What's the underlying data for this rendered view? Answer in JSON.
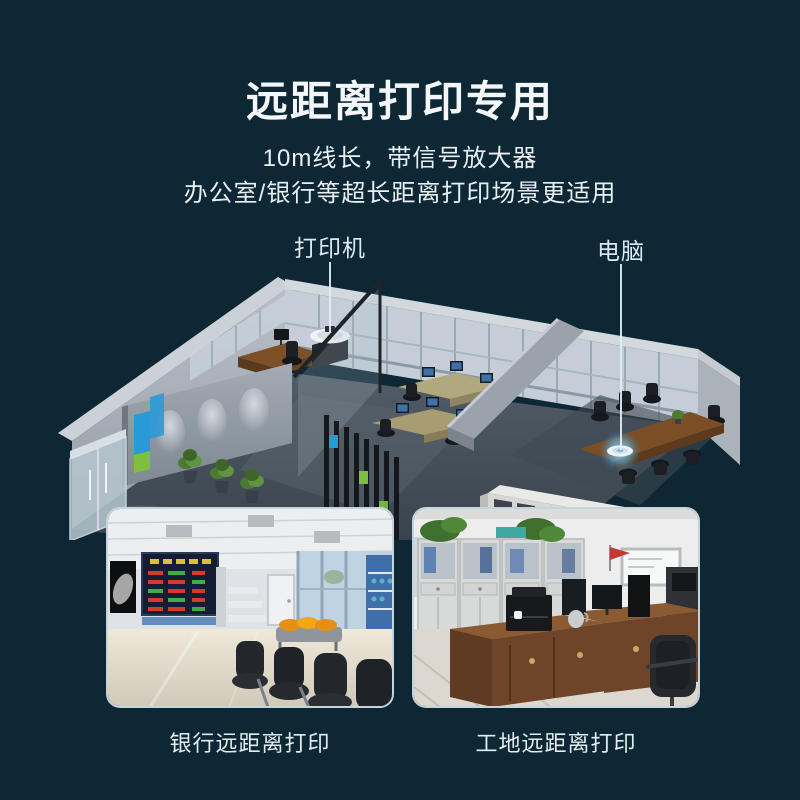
{
  "header": {
    "title": "远距离打印专用",
    "subtitle_line1": "10m线长，带信号放大器",
    "subtitle_line2": "办公室/银行等超长距离打印场景更适用"
  },
  "callouts": {
    "printer_label": "打印机",
    "computer_label": "电脑"
  },
  "photos": {
    "left_caption": "银行远距离打印",
    "right_caption": "工地远距离打印"
  },
  "colors": {
    "background": "#0d2734",
    "title_text": "#f4f7f9",
    "callout_line": "#dfeff8",
    "accent_blue": "#2a9ad6",
    "accent_green": "#7fbf3f",
    "glow_blue": "#8fd4f8"
  }
}
